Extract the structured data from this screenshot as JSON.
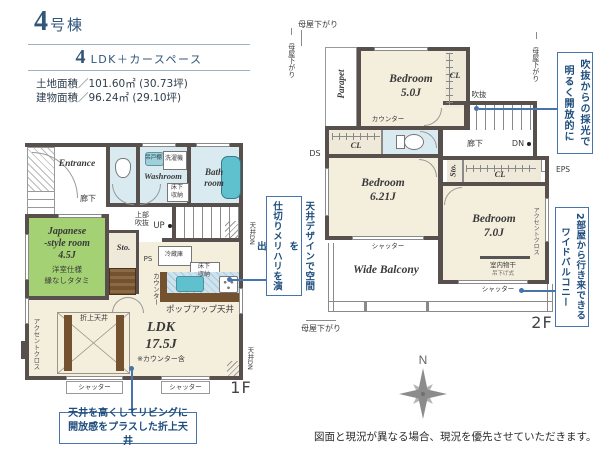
{
  "colors": {
    "ink_blue": "#30567a",
    "rule_blue": "#9db3c5",
    "callout_border": "#4674ab",
    "callout_text": "#1e4d7d",
    "wall": "#57504c",
    "floor": "#f4eedd",
    "tatami": "#a4d173",
    "wet": "#d9ebf1",
    "tub": "#5fc1ce",
    "wood": "#74512f",
    "beige": "#efe9da",
    "text_dark": "#3a3a3a"
  },
  "header": {
    "building_no": "4",
    "building_no_suffix": "号棟",
    "plan_no": "4",
    "plan_suffix": "LDK＋カースペース",
    "land_area": "土地面積／101.60㎡ (30.73坪)",
    "building_area": "建物面積／96.24㎡ (29.10坪)"
  },
  "f1": {
    "entrance": "Entrance",
    "hallway": "廊下",
    "hanging_cupboard": "吊戸棚",
    "washing_machine": "洗濯機",
    "washroom": "Washroom",
    "underfloor_storage_wash": "床下\n収納",
    "bathroom": "Bath\nroom",
    "upper_void": "上部\n吹抜",
    "up": "UP",
    "japanese_room": "Japanese\n-style room\n4.5J",
    "japanese_room_note1": "洋室仕様",
    "japanese_room_note2": "縁なしタタミ",
    "storage": "Sto.",
    "ps": "PS",
    "fridge": "冷蔵庫",
    "underfloor_storage_kitchen": "床下\n収納",
    "counter": "カウンター",
    "popup_ceiling": "ポップアップ天井",
    "ldk": "LDK\n17.5J",
    "ldk_note": "※カウンター含",
    "folded_ceiling": "折上天井",
    "accent_cloth": "アクセントクロス",
    "ceiling_dn_stairs": "天井DN",
    "ceiling_dn_corner": "天井DN",
    "shutter1": "シャッター",
    "shutter2": "シャッター",
    "floor_label": "1F"
  },
  "f2": {
    "moya_top": "母屋下がり",
    "moya_left": "母屋下がり",
    "moya_right": "母屋下がり",
    "moya_bottom": "母屋下がり",
    "parapet": "Parapet",
    "bedroom1": "Bedroom\n5.0J",
    "cl1": "CL",
    "cl2": "CL",
    "cl3": "CL",
    "void": "吹抜",
    "counter": "カウンター",
    "ds": "DS",
    "hallway": "廊下",
    "dn": "DN",
    "storage": "Sto.",
    "eps": "EPS",
    "bedroom2": "Bedroom\n6.21J",
    "bedroom3": "Bedroom\n7.0J",
    "accent_cloth": "アクセントクロス",
    "indoor_drying": "室内物干",
    "indoor_drying_sub": "吊下げ式",
    "shutter1": "シャッター",
    "shutter2": "シャッター",
    "balcony": "Wide Balcony",
    "floor_label": "2F"
  },
  "callouts": {
    "daylight": "吹抜からの採光で\n明るく開放的に",
    "ceiling_design": "天井デザインで空間を\n仕切りメリハリを演出",
    "balcony": "2部屋から行き来できる\nワイドバルコニー",
    "folded_ceiling": "天井を高くしてリビングに\n開放感をプラスした折上天井"
  },
  "compass": {
    "north": "N"
  },
  "disclaimer": "図面と現況が異なる場合、現況を優先させていただきます。"
}
